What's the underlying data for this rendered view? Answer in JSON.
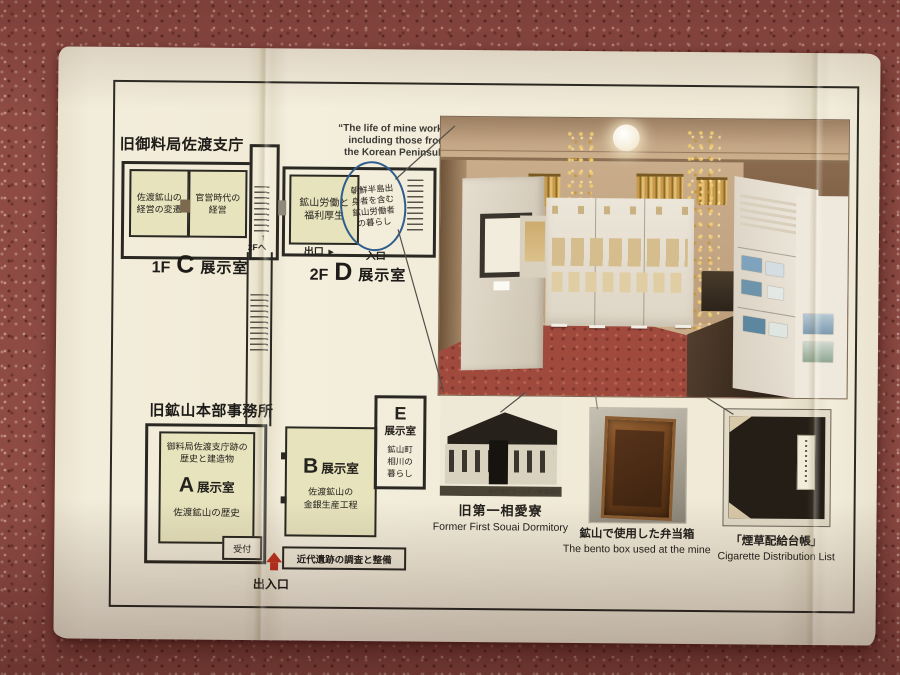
{
  "colors": {
    "carpet": "#8d4b44",
    "paper": "#f1ebd8",
    "room_fill": "#e7e3bd",
    "wall_line": "#2a2822",
    "highlight_circle_blue": "#2e5d8d",
    "entrance_arrow_red": "#c0321f"
  },
  "floorplan": {
    "c": {
      "title": "旧御料局佐渡支庁",
      "rooms": [
        "佐渡鉱山の\n経営の変遷",
        "官営時代の\n経営"
      ],
      "stairs_arrow": "↑",
      "stairs_note": "2Fへ",
      "label": {
        "floor": "1F",
        "letter": "C",
        "word": "展示室"
      }
    },
    "d": {
      "quote": "“The life of mine workers\nincluding those from\nthe Korean Peninsula”",
      "room": "鉱山労働と\n福利厚生",
      "highlight": "朝鮮半島出\n身者を含む\n鉱山労働者\nの暮らし",
      "exit": "出口",
      "exit_arrow": "►",
      "entrance": "入口",
      "label": {
        "floor": "2F",
        "letter": "D",
        "word": "展示室"
      }
    },
    "hq": {
      "title": "旧鉱山本部事務所",
      "a": {
        "desc": "御料局佐渡支庁跡の\n歴史と建造物",
        "letter": "A",
        "word": "展示室",
        "sub": "佐渡鉱山の歴史",
        "reception": "受付"
      },
      "b": {
        "letter": "B",
        "word": "展示室",
        "desc": "佐渡鉱山の\n金銀生産工程",
        "strip": "近代遺跡の調査と整備"
      },
      "e": {
        "letter": "E",
        "word": "展示室",
        "desc": "鉱山町\n相川の\n暮らし"
      },
      "entrance_label": "出入口"
    }
  },
  "photos": {
    "dormitory": {
      "credit": "株式会社ゴールデン佐渡資料",
      "caption_jp": "旧第一相愛寮",
      "caption_en": "Former First Souai Dormitory"
    },
    "bento": {
      "caption_jp": "鉱山で使用した弁当箱",
      "caption_en": "The bento box used at the mine"
    },
    "cigarette": {
      "caption_jp": "「煙草配給台帳」",
      "caption_en": "Cigarette Distribution List"
    }
  }
}
